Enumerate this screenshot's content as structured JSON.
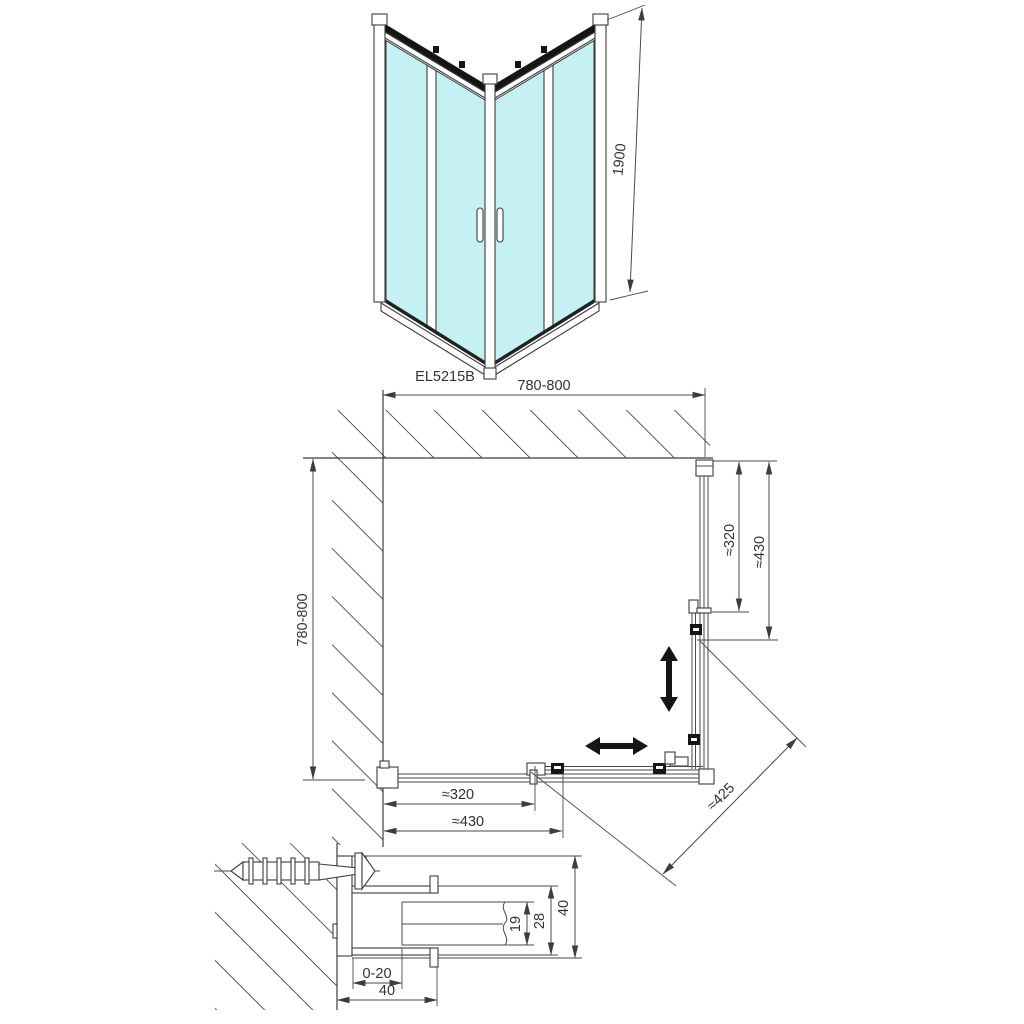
{
  "colors": {
    "glass": "#c6f1f4",
    "line": "#3f3f3f",
    "black": "#151515",
    "text": "#333333"
  },
  "iso_view": {
    "height_label": "1900",
    "model_code": "EL5215B"
  },
  "plan_view": {
    "width_label": "780-800",
    "depth_label": "780-800",
    "right_inner_label": "≈320",
    "right_outer_label": "≈430",
    "bottom_inner_label": "≈320",
    "bottom_outer_label": "≈430",
    "diagonal_label": "≈425"
  },
  "section_view": {
    "adjustment_label": "0-20",
    "bottom_width_label": "40",
    "glass_channel_label": "19",
    "profile_inner_label": "28",
    "profile_height_label": "40"
  }
}
